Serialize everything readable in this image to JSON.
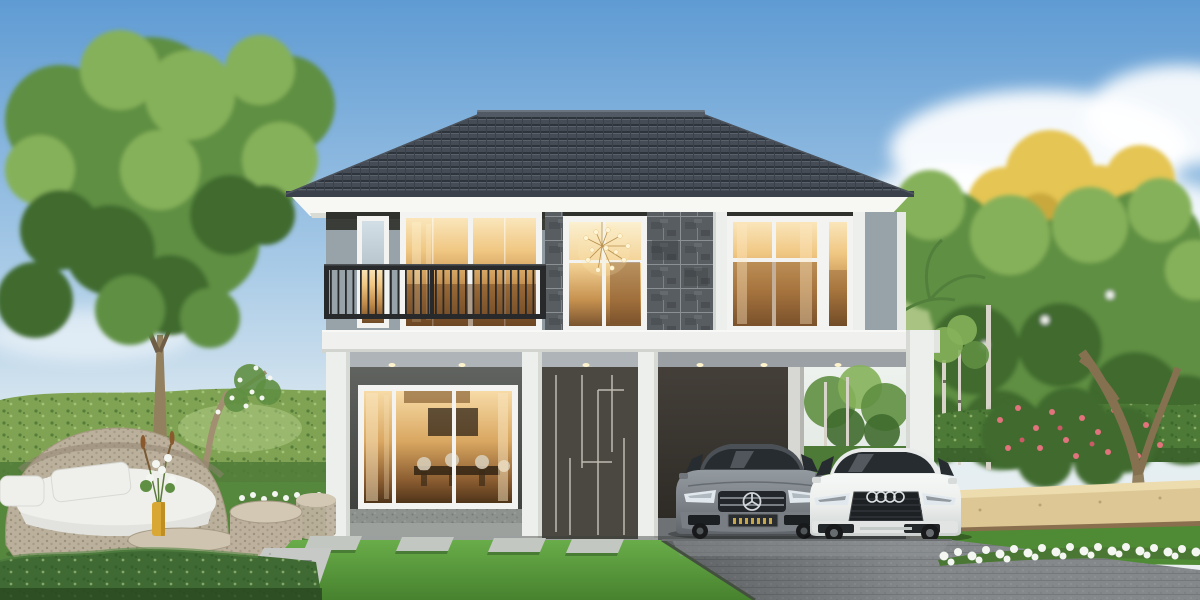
{
  "scene": {
    "type": "architectural-exterior-rendering",
    "objects": [
      "sky",
      "clouds",
      "left-tree",
      "magnolia-tree",
      "left-hedge-wall",
      "right-trees",
      "yellow-flowering-tree",
      "palm-fronds",
      "right-hedge",
      "pink-flower-shrub",
      "garden-tree-trunk",
      "stone-bench",
      "house",
      "hip-roof",
      "roof-soffit",
      "upper-floor",
      "balcony-railing",
      "chandelier",
      "floor-slab",
      "ground-floor",
      "dining-window",
      "entrance-panel",
      "carport",
      "carport-open-view",
      "downlights",
      "mercedes-car",
      "audi-car",
      "garden-daybed",
      "rattan-side-tables",
      "flower-vase",
      "lawn",
      "stepping-stones",
      "gravel-path",
      "foreground-hedge",
      "driveway",
      "white-flower-border",
      "birch-trees"
    ]
  },
  "palette": {
    "sky_top": "#5f9bd3",
    "sky_mid": "#a9cbe7",
    "sky_horizon": "#e4edf1",
    "cloud": "#ffffff",
    "roof_tile": "#454c56",
    "roof_tile_shadow": "#2e343c",
    "roof_ridge": "#515965",
    "soffit": "#f7f8f4",
    "facade_band": "#3a3c38",
    "wall_gray": "#98a3a9",
    "stone_cladding": "#585d61",
    "stone_joint": "#8a9093",
    "window_frame": "#f3f4f1",
    "glass_warm": "#f0c783",
    "glass_warm_deep": "#6e4a27",
    "glass_cool": "#d3dfe6",
    "railing": "#27292b",
    "slab": "#f0f1ee",
    "ceiling": "#aeb4b8",
    "column_white": "#edefec",
    "door_panel": "#56524a",
    "door_line": "#cbc8bf",
    "carport_wall": "#443f39",
    "downlight": "#fff3cd",
    "mercedes_gray": "#7d8388",
    "audi_white": "#eceeec",
    "glass_car": "#272c30",
    "grille": "#1e2124",
    "tire": "#17191b",
    "headlight": "#e2e9ee",
    "plate_yellow": "#d8b54a",
    "lawn_light": "#6cb04c",
    "lawn_dark": "#47822e",
    "hedge": "#7fa353",
    "hedge_dark": "#4d7a36",
    "foreground_hedge": "#3f6a33",
    "foliage": "#5f8f42",
    "foliage_light": "#85b15a",
    "foliage_dark": "#3f6b2d",
    "foliage_pale": "#a9c383",
    "tree_yellow": "#e5c553",
    "tree_yellow_dark": "#c9a93e",
    "trunk": "#93805f",
    "birch": "#d8d4c9",
    "driveway": "#84888b",
    "driveway_dark": "#62666a",
    "paver": "#c3c7c2",
    "bench_stone": "#ddc795",
    "flower_white": "#f4f6f2",
    "flower_pink": "#e2737c",
    "rattan": "#bdb19e",
    "cushion": "#eff0ec",
    "vase_yellow": "#d9a733"
  }
}
